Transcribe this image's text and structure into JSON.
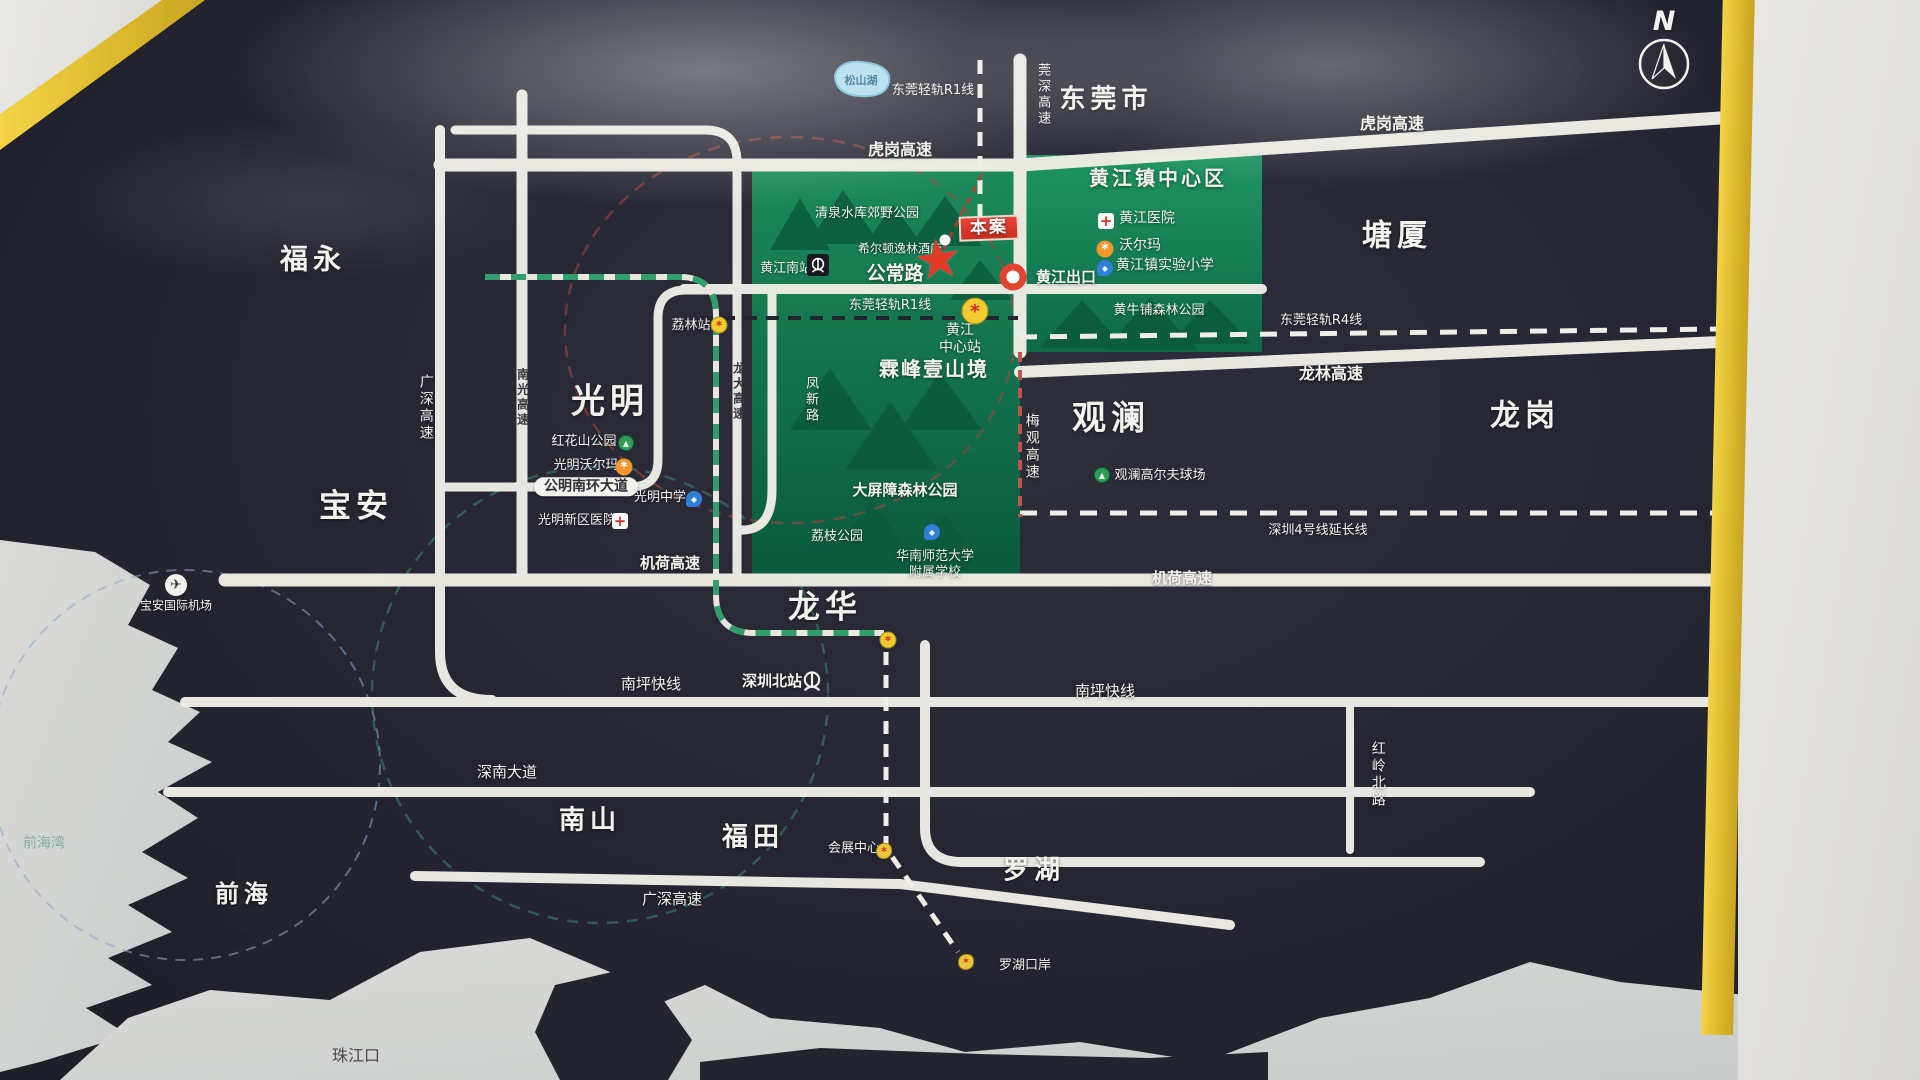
{
  "title": "黄江区位图 (location map board)",
  "colors": {
    "board_dark": "#262733",
    "park_green": "#11714c",
    "road_white": "#efede6",
    "frame_yellow": "#e4c033",
    "benan_red": "#d63427",
    "metro_yellow": "#f2cb30",
    "sea_light": "#d6d6d3",
    "exit_ring_red": "#e2452f"
  },
  "compass": {
    "n": "N"
  },
  "regions": {
    "dongguan": {
      "label": "东莞市"
    },
    "fuyong": {
      "label": "福永"
    },
    "tangxia": {
      "label": "塘厦"
    },
    "guangming": {
      "label": "光明"
    },
    "baoan": {
      "label": "宝安"
    },
    "guanlan": {
      "label": "观澜"
    },
    "longgang": {
      "label": "龙岗"
    },
    "longhua": {
      "label": "龙华"
    },
    "nanshan": {
      "label": "南山"
    },
    "futian": {
      "label": "福田"
    },
    "luohu": {
      "label": "罗湖"
    },
    "qianhai": {
      "label": "前海"
    },
    "zhujiangkou": {
      "label": "珠江口"
    },
    "qianhaiwan": {
      "label": "前海湾"
    },
    "huangjiang_center": {
      "label": "黄江镇中心区"
    }
  },
  "roads": {
    "hugang_l": {
      "label": "虎岗高速"
    },
    "hugang_r": {
      "label": "虎岗高速"
    },
    "guanshen": {
      "label": "莞深高速"
    },
    "gongchang": {
      "label": "公常路"
    },
    "r1_top": {
      "label": "东莞轻轨R1线"
    },
    "r1_mid": {
      "label": "东莞轻轨R1线"
    },
    "r4_line": {
      "label": "东莞轻轨R4线"
    },
    "longlin": {
      "label": "龙林高速"
    },
    "meiguan": {
      "label": "梅观高速"
    },
    "jihe_l": {
      "label": "机荷高速"
    },
    "jihe_r": {
      "label": "机荷高速"
    },
    "nanping_l": {
      "label": "南坪快线"
    },
    "nanping_r": {
      "label": "南坪快线"
    },
    "shennan": {
      "label": "深南大道"
    },
    "guangshen_btm": {
      "label": "广深高速"
    },
    "guangshen_left": {
      "label": "广深高速"
    },
    "nanguang": {
      "label": "南光高速"
    },
    "longda": {
      "label": "龙大高速"
    },
    "fengxin": {
      "label": "凤新路"
    },
    "hongling": {
      "label": "红岭北路"
    },
    "line4": {
      "label": "深圳4号线延长线"
    },
    "gongming_blvd": {
      "label": "公明南环大道"
    }
  },
  "pois": {
    "songshanhu": {
      "label": "松山湖",
      "icon": "lake"
    },
    "qingquan": {
      "label": "清泉水库郊野公园",
      "icon": "park"
    },
    "hilton": {
      "label": "希尔顿逸林酒店",
      "icon": "hotel"
    },
    "benan": {
      "label": "本案",
      "icon": "red-star"
    },
    "hj_exit": {
      "label": "黄江出口",
      "icon": "exit-ring"
    },
    "hj_south_station": {
      "label": "黄江南站",
      "icon": "train-station"
    },
    "lilin_station": {
      "label": "荔林站",
      "icon": "metro-station"
    },
    "hj_center_station_l1": {
      "label": "黄江",
      "icon": "metro-station"
    },
    "hj_center_station_l2": {
      "label": "中心站",
      "icon": "metro-station"
    },
    "linfeng": {
      "label": "霖峰壹山境",
      "icon": "project"
    },
    "hj_hospital": {
      "label": "黄江医院",
      "icon": "hospital-cross"
    },
    "walmart": {
      "label": "沃尔玛",
      "icon": "walmart-spark"
    },
    "hj_school": {
      "label": "黄江镇实验小学",
      "icon": "school-flag"
    },
    "huangniupu": {
      "label": "黄牛铺森林公园",
      "icon": "forest"
    },
    "honghuashan": {
      "label": "红花山公园",
      "icon": "park"
    },
    "gm_walmart": {
      "label": "光明沃尔玛",
      "icon": "walmart-spark"
    },
    "gm_school": {
      "label": "光明中学",
      "icon": "school-flag"
    },
    "gm_hospital": {
      "label": "光明新区医院",
      "icon": "hospital-cross"
    },
    "daping": {
      "label": "大屏障森林公园",
      "icon": "forest"
    },
    "lizhi": {
      "label": "荔枝公园",
      "icon": "park"
    },
    "huashida_l1": {
      "label": "华南师范大学",
      "icon": "school-flag"
    },
    "huashida_l2": {
      "label": "附属学校",
      "icon": "school-flag"
    },
    "golf": {
      "label": "观澜高尔夫球场",
      "icon": "golf-green"
    },
    "szbei_station": {
      "label": "深圳北站",
      "icon": "train-station"
    },
    "convention": {
      "label": "会展中心",
      "icon": "gold-dot"
    },
    "luohu_port": {
      "label": "罗湖口岸",
      "icon": "gold-dot"
    },
    "airport": {
      "label": "宝安国际机场",
      "icon": "airplane"
    }
  }
}
